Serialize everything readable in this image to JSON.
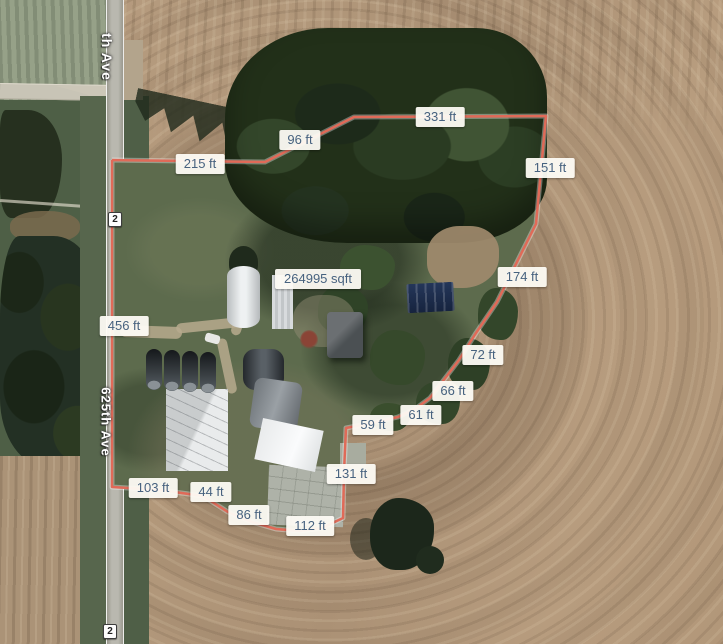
{
  "colors": {
    "boundary_line": "#e06a58",
    "boundary_casing": "rgba(255,255,255,0.35)",
    "label_text": "#47627f",
    "label_bg": "rgba(253,251,244,0.95)"
  },
  "boundary": {
    "area_label": "264995 sqft",
    "area_label_pos": {
      "x": 318,
      "y": 279
    },
    "segments": [
      {
        "label": "215 ft",
        "x": 200,
        "y": 164
      },
      {
        "label": "96 ft",
        "x": 300,
        "y": 140
      },
      {
        "label": "331 ft",
        "x": 440,
        "y": 117
      },
      {
        "label": "151 ft",
        "x": 550,
        "y": 168
      },
      {
        "label": "174 ft",
        "x": 522,
        "y": 277
      },
      {
        "label": "72 ft",
        "x": 483,
        "y": 355
      },
      {
        "label": "66 ft",
        "x": 453,
        "y": 391
      },
      {
        "label": "61 ft",
        "x": 421,
        "y": 415
      },
      {
        "label": "59 ft",
        "x": 373,
        "y": 425
      },
      {
        "label": "131 ft",
        "x": 351,
        "y": 474
      },
      {
        "label": "112 ft",
        "x": 310,
        "y": 526
      },
      {
        "label": "86 ft",
        "x": 249,
        "y": 515
      },
      {
        "label": "44 ft",
        "x": 211,
        "y": 492
      },
      {
        "label": "103 ft",
        "x": 153,
        "y": 488
      },
      {
        "label": "456 ft",
        "x": 124,
        "y": 326
      }
    ]
  },
  "roads": {
    "main_road_name": "625th Ave",
    "top_road_name": "th Ave",
    "shield_label": "2"
  }
}
